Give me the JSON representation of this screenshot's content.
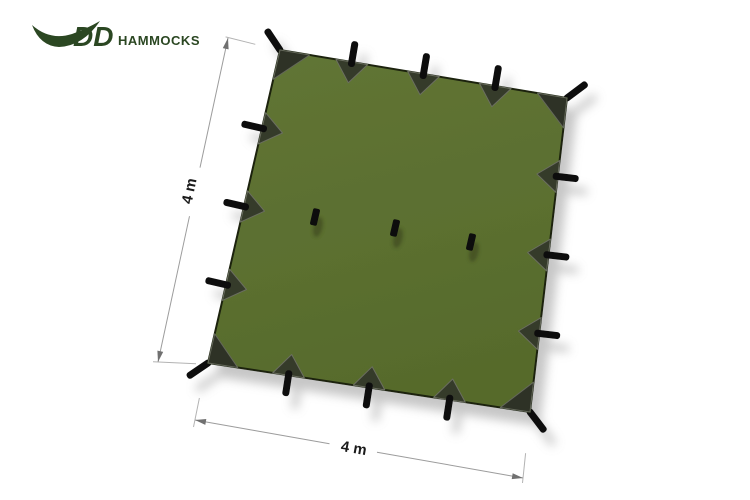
{
  "canvas": {
    "width": 750,
    "height": 500,
    "background": "#ffffff"
  },
  "logo": {
    "brand": "DD",
    "name": "HAMMOCKS",
    "color": "#2b4722",
    "icon": "hammock-swoosh"
  },
  "tarp": {
    "shape": "square",
    "view": "top-down",
    "fill_color": "#5c7031",
    "outline_color": "#1c2410",
    "reinforcement_color": "#363a2a",
    "tab_color": "#0d0d0d",
    "perimeter_attachment_points": 16,
    "center_attachment_points": 3
  },
  "dimensions": {
    "side_label": "4 m",
    "bottom_label": "4 m",
    "line_color": "#9c9c9c",
    "text_color": "#1b1b1b"
  }
}
